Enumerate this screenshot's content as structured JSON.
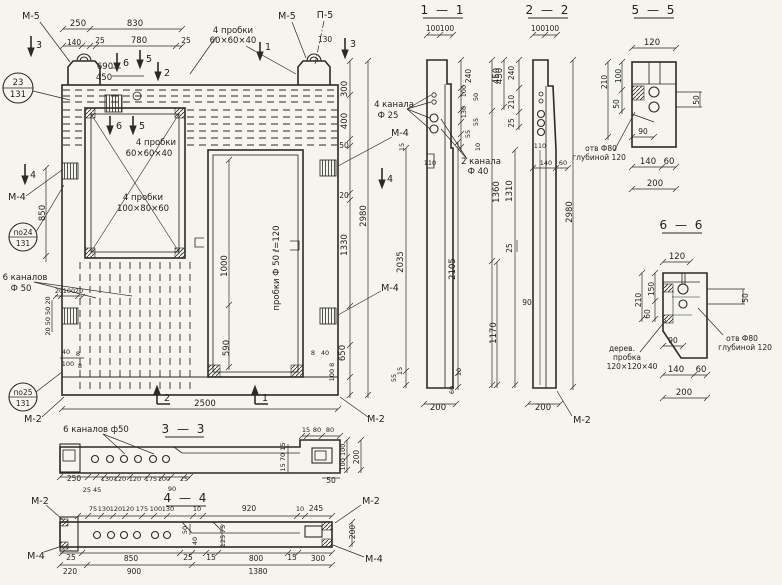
{
  "palette": {
    "ink": "#2b2a26",
    "paper": "#f5f4ef"
  },
  "labels": {
    "m2": "М-2",
    "m4": "М-4",
    "m5": "М-5",
    "p5": "П-5",
    "mk1": "1",
    "mk2": "2",
    "mk3": "3",
    "mk4": "4",
    "mk5": "5",
    "mk6": "6",
    "pos23": "23",
    "pos24": "по24",
    "pos25": "по25",
    "series": "131",
    "probki4": "4 пробки",
    "size_60": "60×60×40",
    "size_100": "100×80×60",
    "kanala4": "4 канала",
    "f25": "Ф 25",
    "kanala2": "2 канала",
    "f40": "Ф 40",
    "kanalov6": "6 каналов",
    "f50": "Ф 50",
    "kanalov6_f50": "6 каналов ф50",
    "probki_f50": "пробки Ф 50 ℓ=120",
    "otv_f80": "отв Ф80",
    "glubinoy": "глубиной 120",
    "derev": "дерев.",
    "probka": "пробка",
    "size_120": "120×120×40"
  },
  "sections": {
    "s11": "1 — 1",
    "s22": "2 — 2",
    "s33": "3 — 3",
    "s44": "4 — 4",
    "s55": "5 — 5",
    "s66": "6 — 6"
  },
  "dims": {
    "8": "8",
    "10": "10",
    "15": "15",
    "20": "20",
    "25": "25",
    "40": "40",
    "45": "45",
    "50": "50",
    "55": "55",
    "60": "60",
    "70": "70",
    "75": "75",
    "80": "80",
    "90": "90",
    "100": "100",
    "110": "110",
    "120": "120",
    "125": "125",
    "130": "130",
    "140": "140",
    "150": "150",
    "175": "175",
    "200": "200",
    "210": "210",
    "220": "220",
    "240": "240",
    "245": "245",
    "250": "250",
    "300": "300",
    "400": "400",
    "450": "450",
    "590": "590",
    "650": "650",
    "690": "690",
    "780": "780",
    "800": "800",
    "830": "830",
    "850": "850",
    "900": "900",
    "920": "920",
    "1000": "1000",
    "1170": "1170",
    "1310": "1310",
    "1330": "1330",
    "1360": "1360",
    "1380": "1380",
    "2035": "2035",
    "2105": "2105",
    "2500": "2500",
    "2980": "2980"
  },
  "combos": {
    "d20_50_50_20": "20 50 50 20",
    "d100_8": "100 8",
    "d25_45": "25 45",
    "d15_70_15": "15 70 15",
    "d100_100": "100 100"
  }
}
